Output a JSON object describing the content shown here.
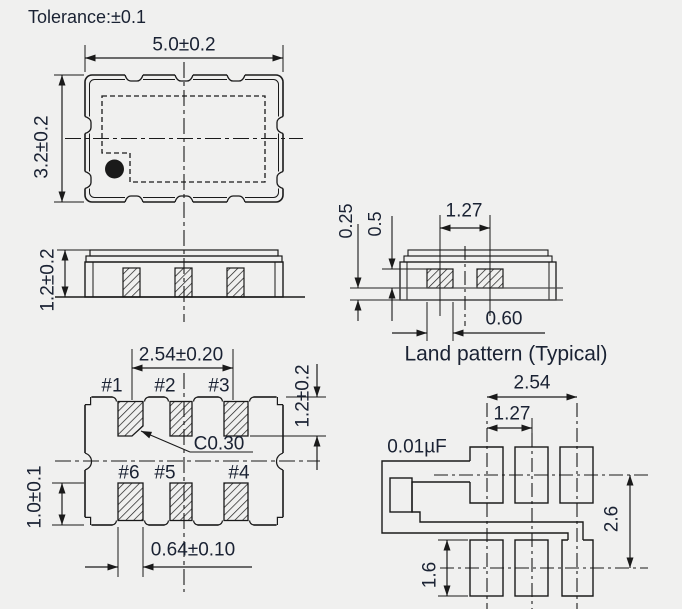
{
  "colors": {
    "background": "#f0f0ef",
    "line": "#1a1a1a",
    "text": "#1a2233"
  },
  "note": {
    "tolerance": "Tolerance:±0.1"
  },
  "top_view": {
    "width_dim": "5.0±0.2",
    "height_dim": "3.2±0.2"
  },
  "side_view": {
    "height_dim": "1.2±0.2"
  },
  "bottom_view": {
    "pad_pitch_dim": "2.54±0.20",
    "pad_length_top_dim": "1.2±0.2",
    "pad_length_bottom_dim": "1.0±0.1",
    "pad_width_dim": "0.64±0.10",
    "chamfer_dim": "C0.30",
    "pad_labels": [
      "#1",
      "#2",
      "#3",
      "#6",
      "#5",
      "#4"
    ]
  },
  "land_side_view": {
    "pad_pitch_dim": "1.27",
    "land_thickness_dim": "0.25",
    "land_height_dim": "0.5",
    "land_width_dim": "0.60",
    "title": "Land pattern (Typical)"
  },
  "land_pattern_view": {
    "outer_pitch_dim": "2.54",
    "inner_pitch_dim": "1.27",
    "row_pitch_dim": "2.6",
    "pad_height_dim": "1.6",
    "capacitor_label": "0.01µF"
  }
}
